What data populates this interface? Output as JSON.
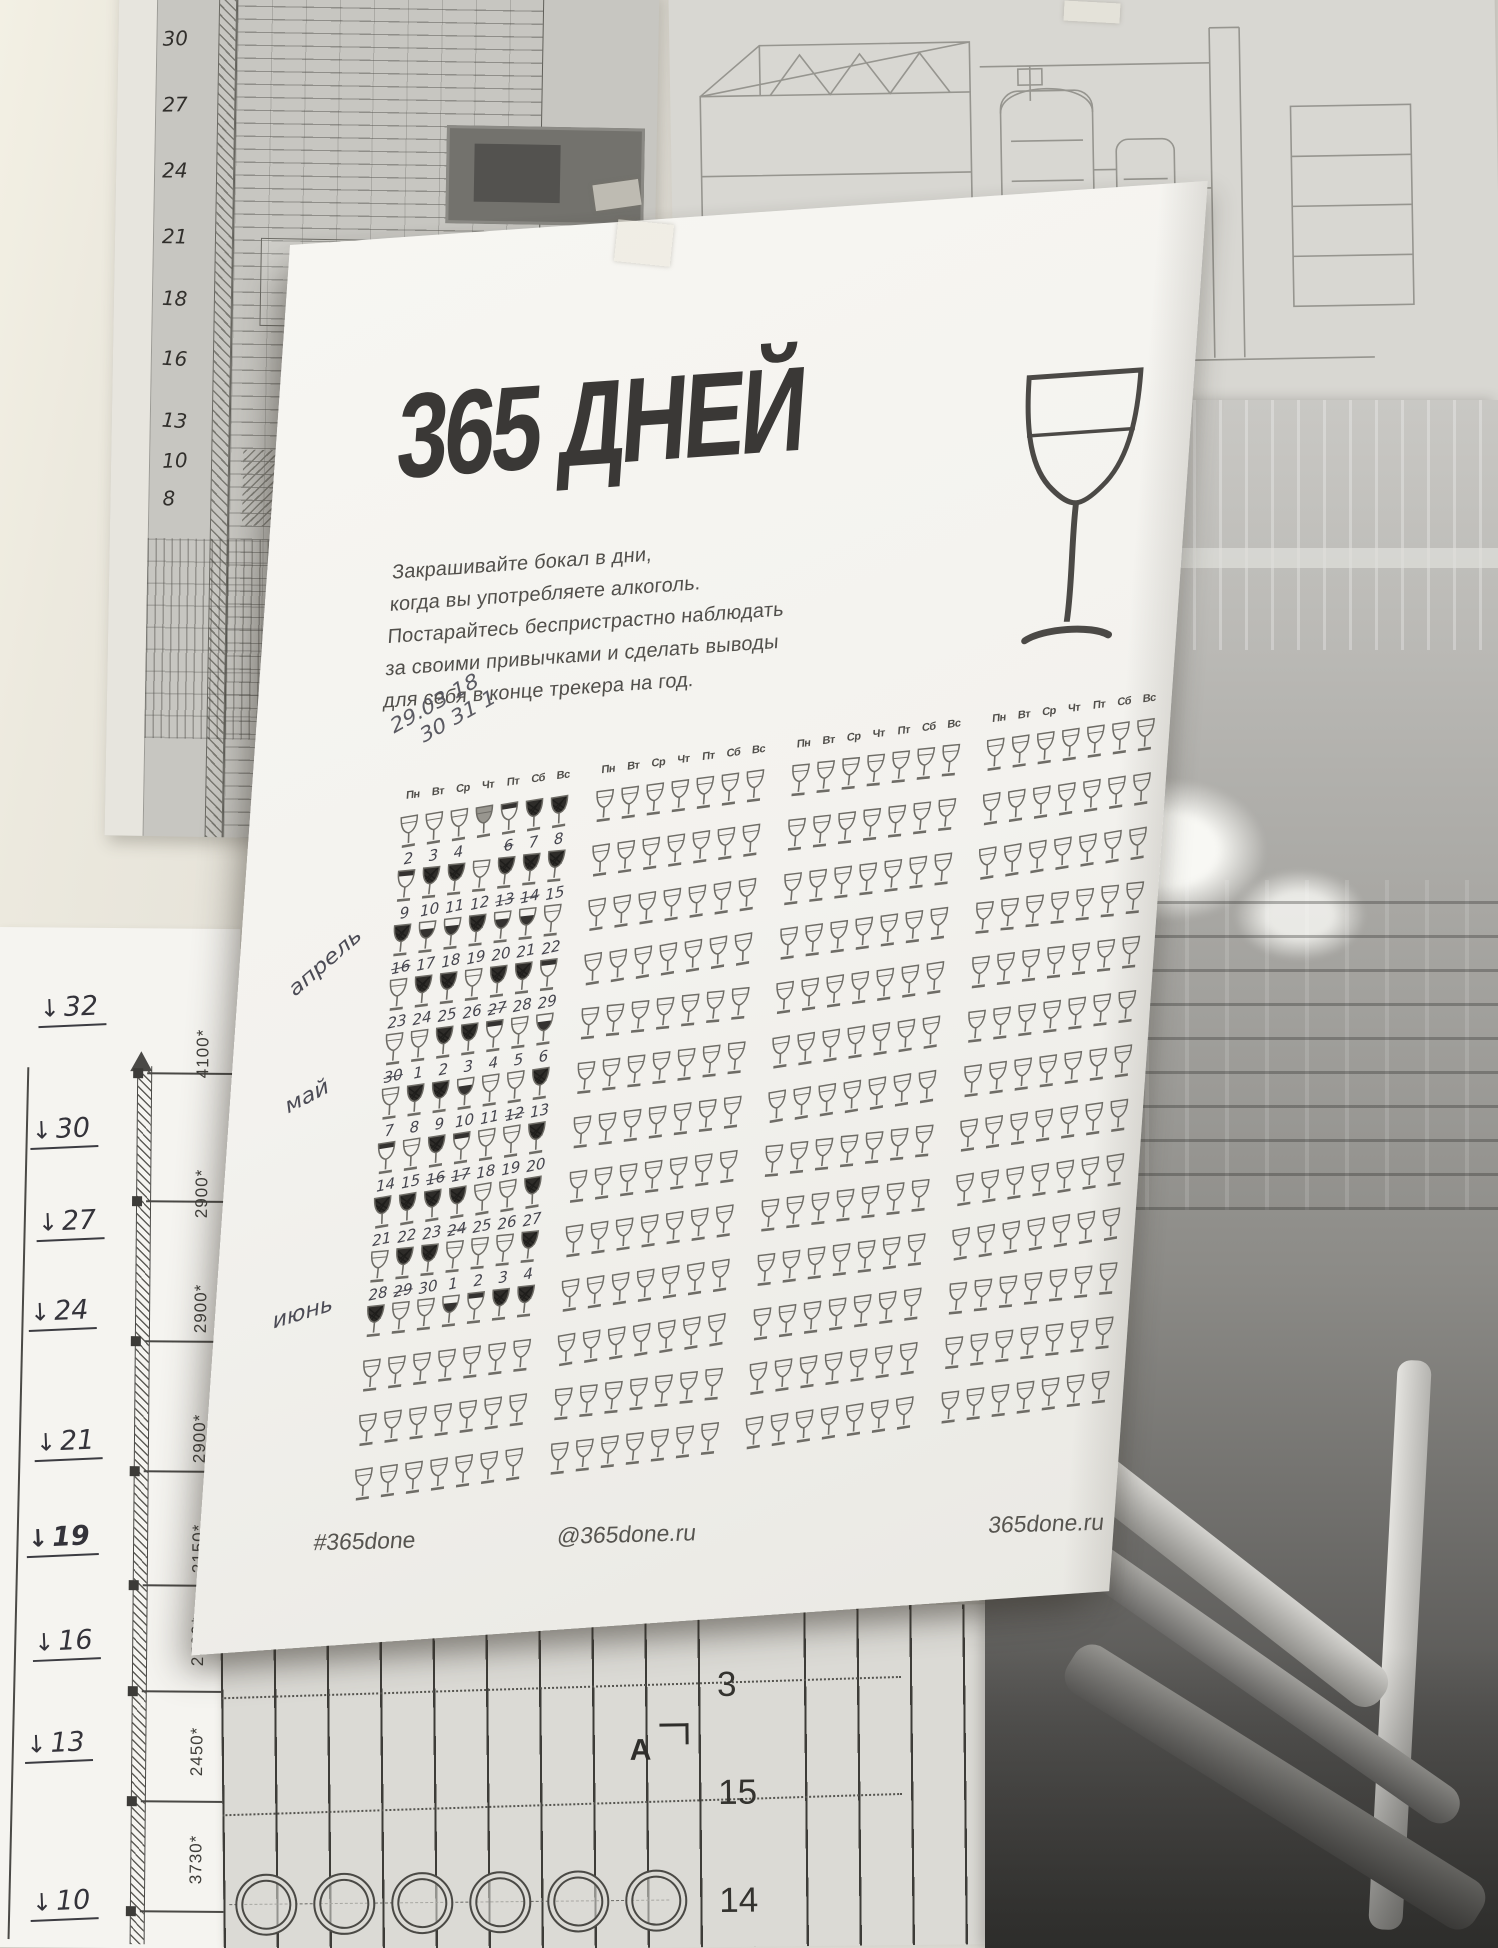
{
  "poster": {
    "title": "365 ДНЕЙ",
    "intro_lines": [
      "Закрашивайте бокал в дни,",
      "когда вы употребляете алкоголь.",
      "Постарайтесь беспристрастно наблюдать",
      "за своими привычками и сделать выводы",
      "для себя в конце трекера на год."
    ],
    "big_glass_icon": "wine-glass-outline",
    "weekday_headers": [
      "Пн",
      "Вт",
      "Ср",
      "Чт",
      "Пт",
      "Сб",
      "Вс"
    ],
    "handwritten": {
      "date_note_line1": "29.03 18",
      "date_note_line2": "30 31 1",
      "month_notes": [
        "апрель",
        "май",
        "июнь"
      ]
    },
    "tracker": {
      "columns": 4,
      "rows_per_column": 13,
      "glass_states_legend": {
        "p": "empty-glass",
        "s": "scribbled-dark",
        "w": "wine-filled",
        "t": "top-band-filled",
        "g": "gray-shaded"
      },
      "column1_rows": [
        {
          "glasses": "pppgtss",
          "labels": [
            "2",
            "3",
            "4",
            "",
            "6",
            "7",
            "8"
          ],
          "struck": [
            0,
            0,
            0,
            0,
            1,
            0,
            0
          ]
        },
        {
          "glasses": "tsspsss",
          "labels": [
            "9",
            "10",
            "11",
            "12",
            "13",
            "14",
            "15"
          ],
          "struck": [
            0,
            0,
            0,
            0,
            1,
            1,
            0
          ]
        },
        {
          "glasses": "swwswwp",
          "labels": [
            "16",
            "17",
            "18",
            "19",
            "20",
            "21",
            "22"
          ],
          "struck": [
            1,
            0,
            0,
            0,
            0,
            0,
            0
          ]
        },
        {
          "glasses": "psspsst",
          "labels": [
            "23",
            "24",
            "25",
            "26",
            "27",
            "28",
            "29"
          ],
          "struck": [
            0,
            0,
            0,
            0,
            1,
            0,
            0
          ]
        },
        {
          "glasses": "ppsstpw",
          "labels": [
            "30",
            "1",
            "2",
            "3",
            "4",
            "5",
            "6"
          ],
          "struck": [
            1,
            0,
            0,
            0,
            0,
            0,
            0
          ]
        },
        {
          "glasses": "psswpps",
          "labels": [
            "7",
            "8",
            "9",
            "10",
            "11",
            "12",
            "13"
          ],
          "struck": [
            0,
            0,
            0,
            0,
            0,
            1,
            0
          ]
        },
        {
          "glasses": "tpstpps",
          "labels": [
            "14",
            "15",
            "16",
            "17",
            "18",
            "19",
            "20"
          ],
          "struck": [
            0,
            0,
            1,
            1,
            0,
            0,
            0
          ]
        },
        {
          "glasses": "sssspps",
          "labels": [
            "21",
            "22",
            "23",
            "24",
            "25",
            "26",
            "27"
          ],
          "struck": [
            0,
            0,
            0,
            1,
            0,
            0,
            0
          ]
        },
        {
          "glasses": "pssppps",
          "labels": [
            "28",
            "29",
            "30",
            "1",
            "2",
            "3",
            "4"
          ],
          "struck": [
            0,
            1,
            0,
            0,
            0,
            0,
            0
          ]
        },
        {
          "glasses": "sppwtss",
          "labels": [],
          "struck": []
        },
        {
          "glasses": "ppppppp",
          "labels": [],
          "struck": []
        },
        {
          "glasses": "ppppppp",
          "labels": [],
          "struck": []
        },
        {
          "glasses": "ppppppp",
          "labels": [],
          "struck": []
        }
      ],
      "other_columns": "all-empty"
    },
    "footer": {
      "left": "#365done",
      "center": "@365done.ru",
      "right": "365done.ru"
    },
    "ink_color": "#3a3836",
    "pencil_color": "#4b4b55"
  },
  "background": {
    "left_scale_drawing": {
      "levels": [
        "32",
        "30",
        "27",
        "24",
        "21",
        "19",
        "16",
        "13",
        "10"
      ],
      "dimensions": [
        "4100*",
        "2900*",
        "2900*",
        "2900*",
        "2150*",
        "2500*",
        "2450*",
        "3730*"
      ]
    },
    "top_left_blueprint": {
      "levels": [
        "30",
        "27",
        "24",
        "21",
        "18",
        "16",
        "13",
        "10",
        "8"
      ]
    },
    "bottom_drawing": {
      "section_label": "A",
      "numbers": [
        "3",
        "15",
        "14"
      ]
    }
  }
}
